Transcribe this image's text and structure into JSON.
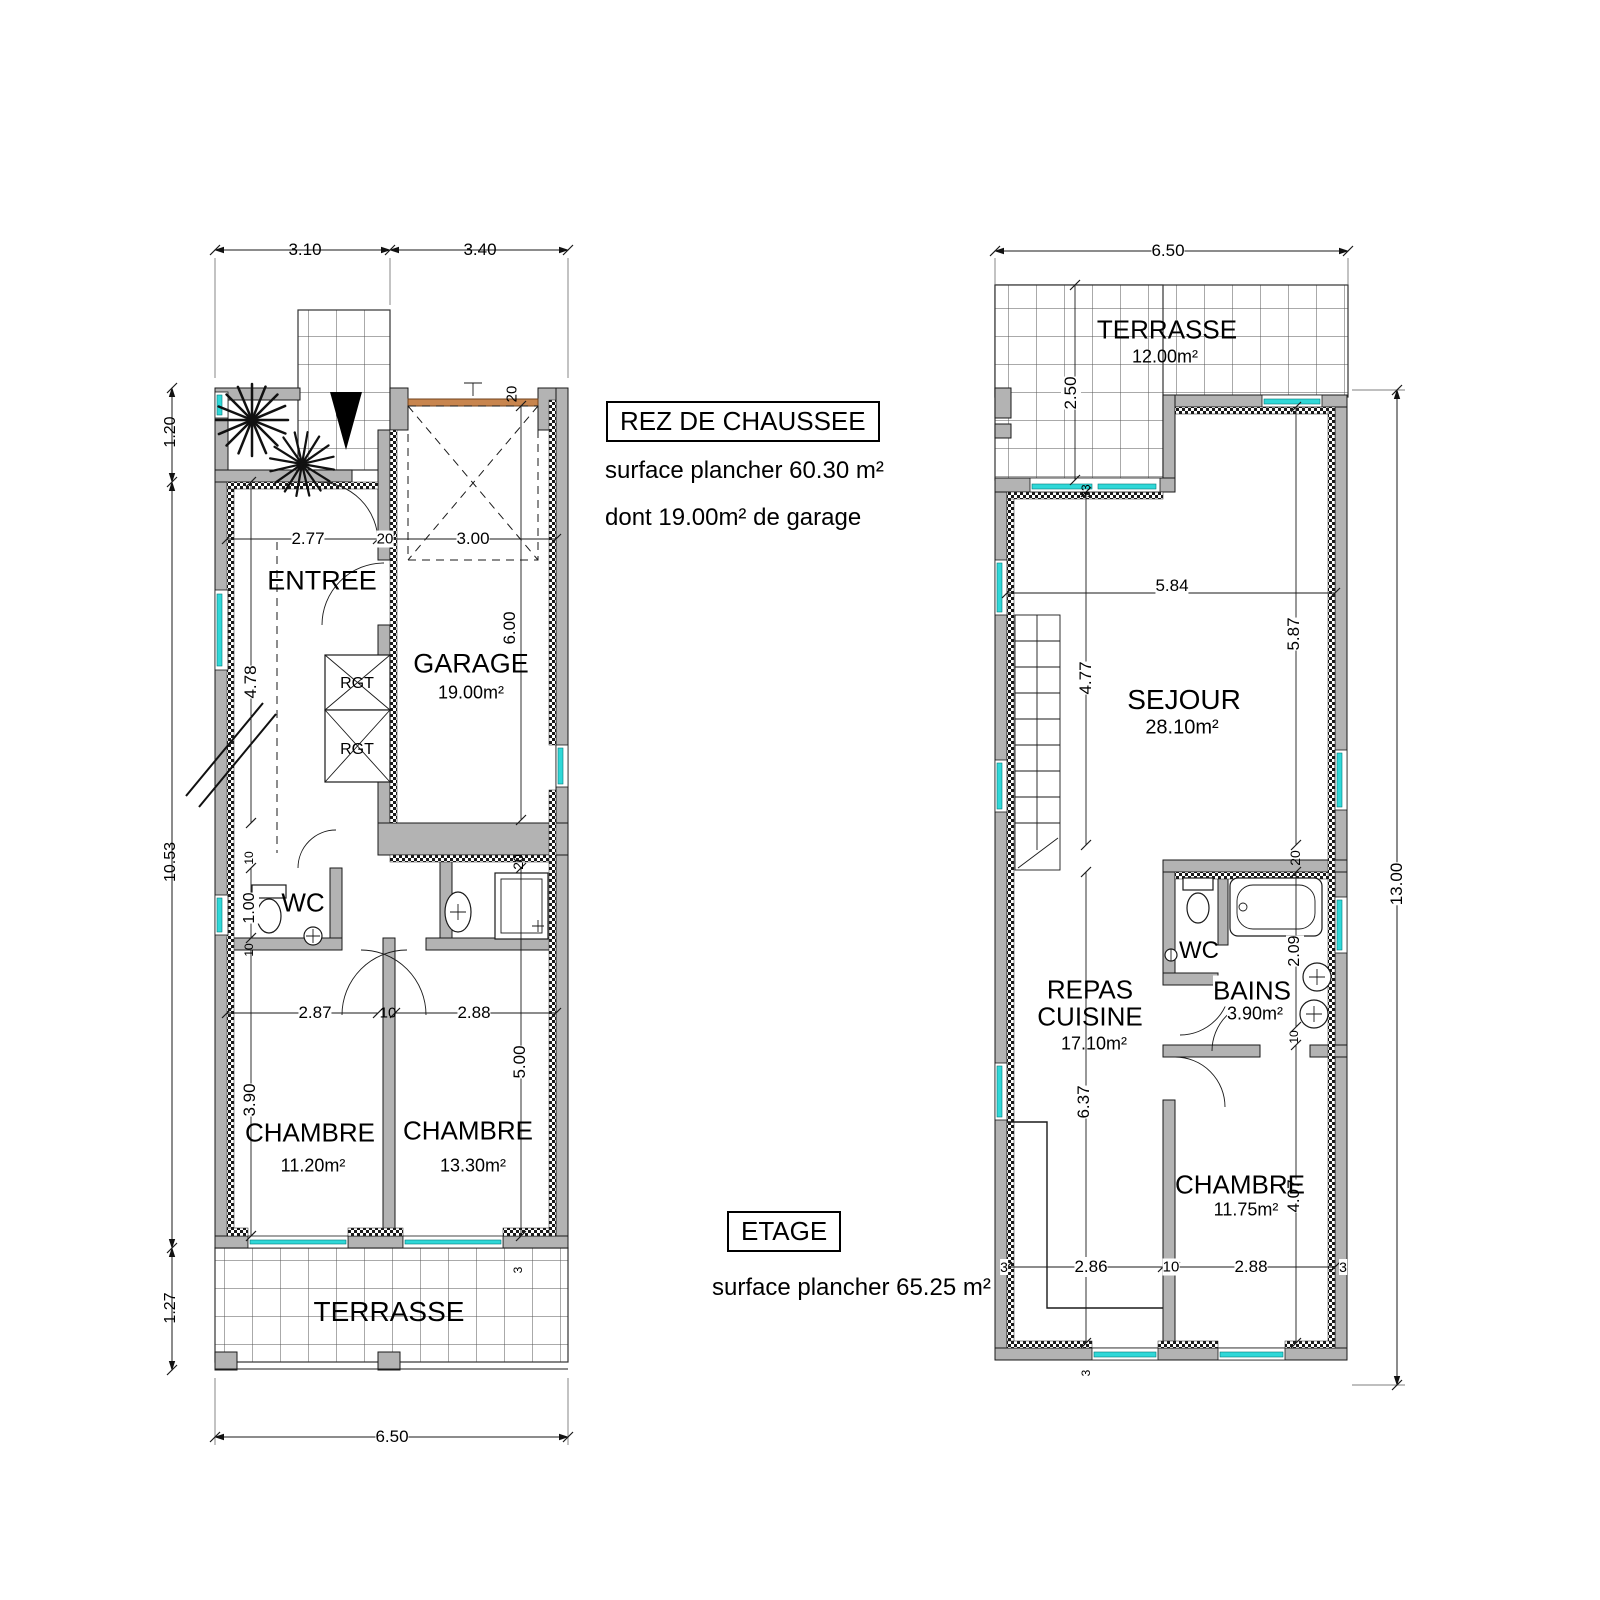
{
  "ground": {
    "title": "REZ DE CHAUSSEE",
    "surface_line1": "surface plancher 60.30 m²",
    "surface_line2": "dont 19.00m² de garage",
    "rooms": {
      "entree": "ENTREE",
      "garage": "GARAGE",
      "garage_area": "19.00m²",
      "rgt1": "RGT",
      "rgt2": "RGT",
      "wc": "WC",
      "chambre1": "CHAMBRE",
      "chambre1_area": "11.20m²",
      "chambre2": "CHAMBRE",
      "chambre2_area": "13.30m²",
      "terrasse": "TERRASSE"
    },
    "dims": {
      "top_left": "3.10",
      "top_right": "3.40",
      "side_top": "1.20",
      "side_mid": "10.53",
      "side_bottom": "1.27",
      "entree_width": "2.77",
      "wall_entree": "20",
      "garage_width": "3.00",
      "garage_depth": "6.00",
      "garage_door": "20",
      "hall_depth": "4.78",
      "wc_depth": "1.00",
      "wc_wall_top": "10",
      "wc_wall_bottom": "10",
      "chambre_depth": "3.90",
      "chambre1_width": "2.87",
      "divider": "10",
      "chambre2_width": "2.88",
      "chambre2_depth": "5.00",
      "wall_mid": "20",
      "sill": "3",
      "bottom_width": "6.50"
    }
  },
  "etage": {
    "title": "ETAGE",
    "surface_line1": "surface plancher 65.25 m²",
    "rooms": {
      "terrasse": "TERRASSE",
      "terrasse_area": "12.00m²",
      "sejour": "SEJOUR",
      "sejour_area": "28.10m²",
      "wc": "WC",
      "bains": "BAINS",
      "bains_area": "3.90m²",
      "repas_line1": "REPAS",
      "repas_line2": "CUISINE",
      "repas_area": "17.10m²",
      "chambre": "CHAMBRE",
      "chambre_area": "11.75m²"
    },
    "dims": {
      "top_width": "6.50",
      "terrasse_depth": "2.50",
      "sill_top": "33",
      "sejour_width": "5.84",
      "sejour_left": "4.77",
      "sejour_right": "5.87",
      "wall_bains": "20",
      "bains_depth": "2.09",
      "wall_bains_bottom": "10",
      "repas_depth": "6.37",
      "chambre_depth": "4.07",
      "sill_bottom_left": "3",
      "chambre_hall_width": "2.86",
      "wall_bottom": "10",
      "chambre_width": "2.88",
      "sill_bottom_right": "3",
      "sill_bottom_mid": "3",
      "side_height": "13.00"
    }
  }
}
